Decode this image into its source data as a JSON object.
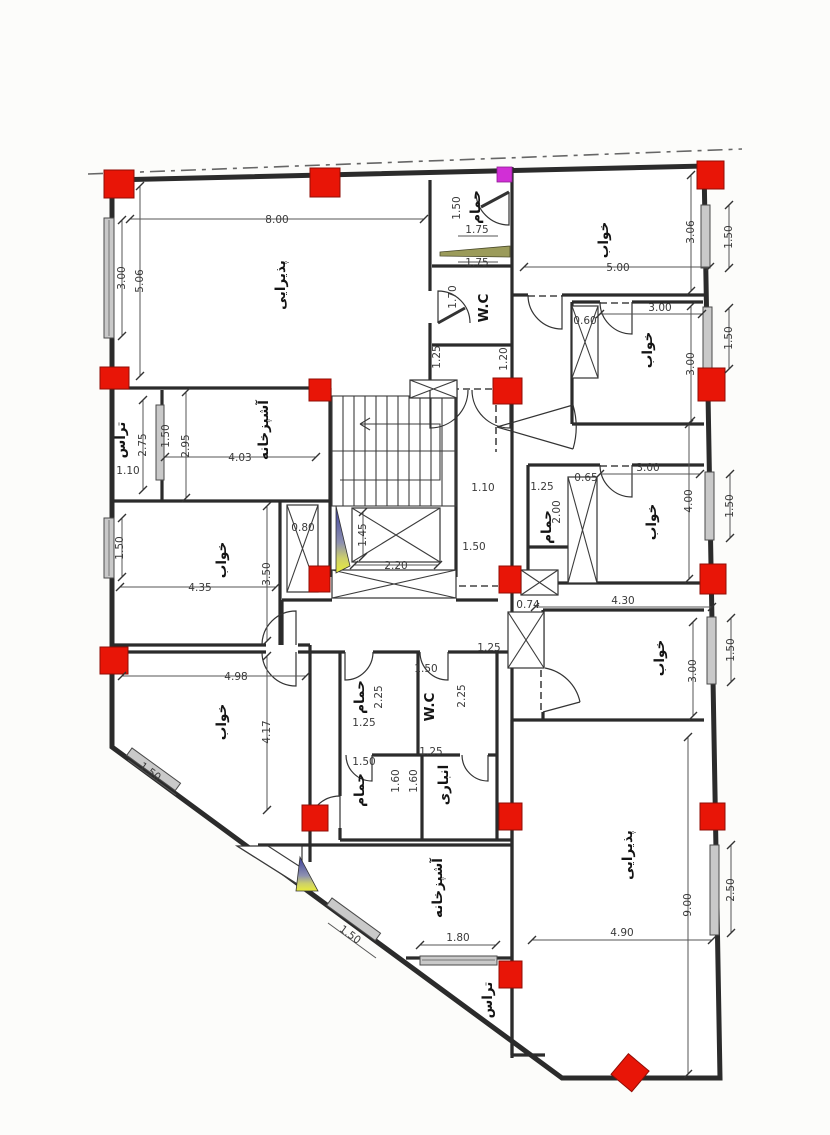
{
  "drawing": {
    "type": "architectural-floor-plan",
    "language": "persian-arabic"
  },
  "colors": {
    "column_red": "#e81507",
    "magenta_marker": "#d12fd6",
    "wall": "#2b2b2b",
    "wedge_blue": "#3b3f9c",
    "wedge_yellow": "#e9ec3a",
    "window_olive": "#9b9b5a"
  },
  "rooms": {
    "reception": "پذیرایی",
    "kitchen": "آشپزخانه",
    "bedroom": "خواب",
    "bath": "حمام",
    "wc": "W.C",
    "storage": "انباری",
    "terrace": "تراس"
  },
  "dims": {
    "top_width": "8.00",
    "left_total": "5.06",
    "left_window_top": "3.00",
    "bath_top_height": "1.50",
    "bath_top_width_a": "1.75",
    "bath_top_width_b": "1.75",
    "wc_top_height": "1.70",
    "br1_width": "5.00",
    "br1_height": "3.06",
    "window_r1": "1.50",
    "br2_width": "3.00",
    "br2_height": "3.00",
    "window_r2": "1.50",
    "shaft_br2": "0.60",
    "hall_a": "1.25",
    "hall_b": "1.20",
    "terrace1_height": "2.75",
    "terrace1_window": "1.50",
    "kitchen1_height": "2.95",
    "terrace1_width": "1.10",
    "kitchen1_width": "4.03",
    "hall_c": "1.10",
    "hall_d": "1.25",
    "bath_mid_height": "2.00",
    "shaft_br3": "0.65",
    "br3_width": "3.00",
    "br3_height": "4.00",
    "window_r3": "1.50",
    "window_l2": "1.50",
    "br4_width": "4.35",
    "br4_height": "3.50",
    "shaft_mid": "0.80",
    "elevator_depth": "1.45",
    "elevator_width": "2.20",
    "hall_e": "1.50",
    "shaft_br5": "0.74",
    "br5_width": "4.30",
    "br5_height": "3.00",
    "window_r4": "1.50",
    "br6_width": "4.98",
    "br6_height": "4.17",
    "corridor": "1.25",
    "bath1_width": "1.25",
    "bath1_height": "2.25",
    "wc2_width": "1.50",
    "wc2_height": "2.25",
    "bath2_width": "1.50",
    "bath2_height": "1.60",
    "storage_width": "1.25",
    "storage_height": "1.60",
    "window_diag1": "1.50",
    "window_diag2": "1.50",
    "window_bottom": "1.80",
    "reception2_height": "9.00",
    "reception2_width": "4.90",
    "window_r5": "2.50"
  }
}
